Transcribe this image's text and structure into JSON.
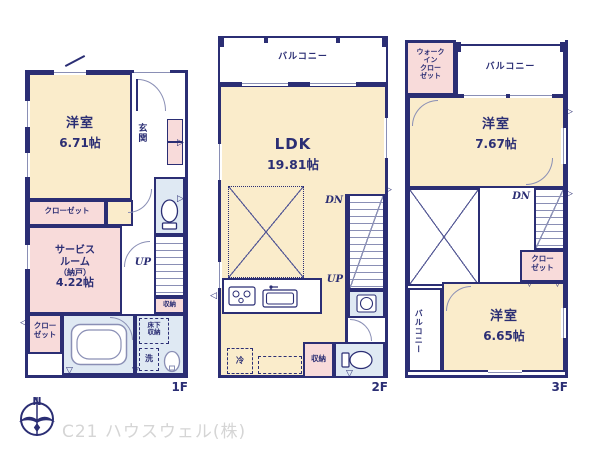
{
  "footer": {
    "company": "C21 ハウスウェル(株)",
    "north": "N"
  },
  "f1": {
    "floor_label": "1F",
    "room1_name": "洋室",
    "room1_size": "6.71帖",
    "genkan": "玄関",
    "closet_top": "クローゼット",
    "service_l1": "サービス",
    "service_l2": "ルーム",
    "service_l3": "（納戸）",
    "service_l4": "4.22帖",
    "closet_left_l1": "クロー",
    "closet_left_l2": "ゼット",
    "up": "UP",
    "storage": "収納",
    "underfloor_l1": "床下",
    "underfloor_l2": "収納",
    "wash": "洗"
  },
  "f2": {
    "floor_label": "2F",
    "balcony": "バルコニー",
    "ldk_name": "LDK",
    "ldk_size": "19.81帖",
    "dn": "DN",
    "up": "UP",
    "fridge": "冷",
    "storage": "収納"
  },
  "f3": {
    "floor_label": "3F",
    "wic_l1": "ウォーク",
    "wic_l2": "イン",
    "wic_l3": "クロー",
    "wic_l4": "ゼット",
    "balcony_top": "バルコニー",
    "balcony_left": "バルコニー",
    "room1_name": "洋室",
    "room1_size": "7.67帖",
    "room2_name": "洋室",
    "room2_size": "6.65帖",
    "closet_l1": "クロー",
    "closet_l2": "ゼット",
    "dn": "DN"
  },
  "colors": {
    "wall": "#2b2e74",
    "room": "#faeccb",
    "closet": "#f8dbda",
    "bath": "#dfe9f3",
    "company_text": "#d5d5d5"
  }
}
